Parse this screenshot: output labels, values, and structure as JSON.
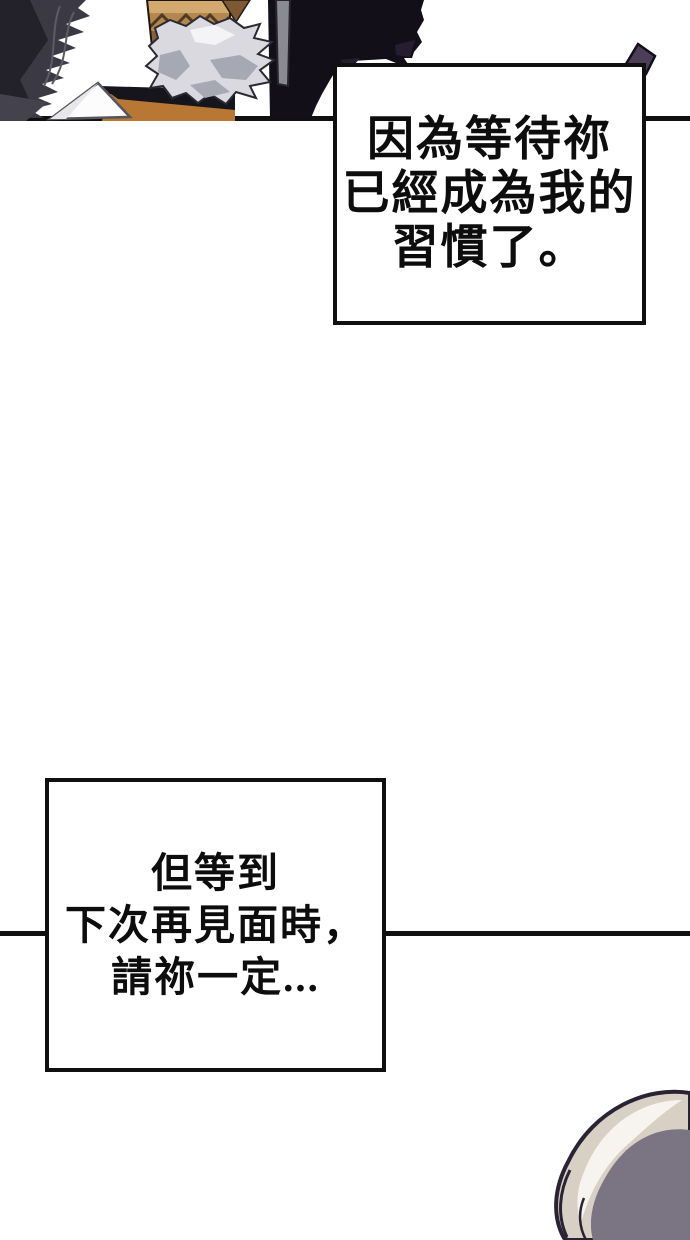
{
  "page": {
    "width_px": 690,
    "height_px": 1240,
    "background": "#ffffff",
    "kind": "webtoon comic page"
  },
  "palette": {
    "ink": "#101010",
    "paper_white": "#fcfcfd",
    "cloak_dark": "#3a3944",
    "cloak_shadow": "#23222a",
    "cloak_streak": "#5d5c66",
    "mass_black": "#120f18",
    "mass_purple": "#251e30",
    "gray_strip": "#8a8a92",
    "hat_tan": "#b18549",
    "hat_tan_light": "#d2a96f",
    "hat_band": "#b3874e",
    "hat_brown_dark": "#86603a",
    "hat_zigzag": "#4e3a24",
    "hair_light": "#d9d9df",
    "hair_shadow": "#a6a8b4",
    "hair_highlight": "#f4f4f7",
    "shoulder_orange": "#b97734",
    "strap_black": "#17151c",
    "spike_purple": "#4d3e58",
    "head_cream": "#d9d0c5",
    "head_gray": "#7b7483",
    "head_highlight": "#f7f4f0",
    "head_outline": "#2a2333"
  },
  "bubbles": {
    "top": {
      "text": "因為等待祢\n已經成為我的\n習慣了。"
    },
    "bottom": {
      "text": "但等到\n下次再見面時，\n請祢一定..."
    }
  }
}
